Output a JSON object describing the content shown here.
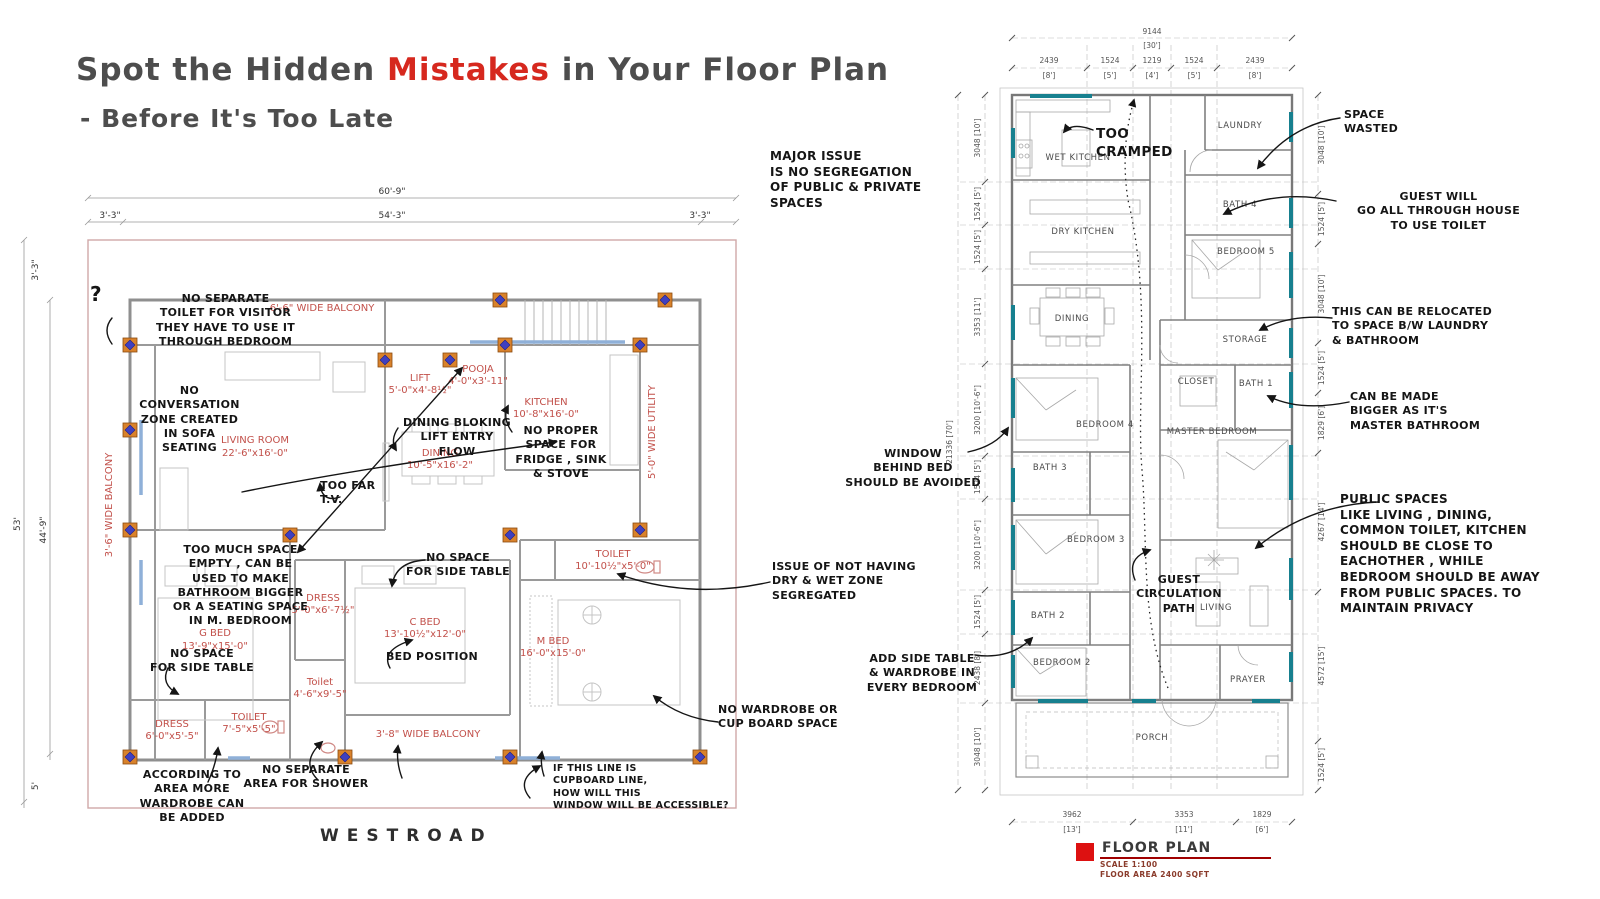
{
  "title": {
    "part1": "Spot the Hidden ",
    "highlight": "Mistakes",
    "part2": " in Your Floor Plan",
    "line2": "- Before It's Too Late"
  },
  "left_plan": {
    "caption": "WESTROAD",
    "dims": {
      "top_total": "60'-9\"",
      "top_left": "3'-3\"",
      "top_mid": "54'-3\"",
      "top_right": "3'-3\"",
      "side_total": "53'",
      "side_inner": "44'-9\"",
      "side_top": "3'-3\"",
      "side_bottom": "5'"
    },
    "rooms": {
      "balcony_top": {
        "name": "6'-6\" WIDE BALCONY"
      },
      "living": {
        "name": "LIVING ROOM",
        "size": "22'-6\"x16'-0\""
      },
      "lift": {
        "name": "LIFT",
        "size": "5'-0\"x4'-8½\""
      },
      "pooja": {
        "name": "POOJA",
        "size": "4'-0\"x3'-11\""
      },
      "kitchen": {
        "name": "KITCHEN",
        "size": "10'-8\"x16'-0\""
      },
      "dining": {
        "name": "DINING",
        "size": "10'-5\"x16'-2\""
      },
      "utility": {
        "name": "5'-0\" WIDE UTILITY"
      },
      "balcony_left": {
        "name": "3'-6\" WIDE BALCONY"
      },
      "gbed": {
        "name": "G BED",
        "size": "13'-9\"x15'-0\""
      },
      "dress1": {
        "name": "DRESS",
        "size": "5'-0\"x6'-7½\""
      },
      "cbed": {
        "name": "C BED",
        "size": "13'-10½\"x12'-0\""
      },
      "toilet_small": {
        "name": "Toilet",
        "size": "4'-6\"x9'-5\""
      },
      "toilet_m": {
        "name": "TOILET",
        "size": "10'-10½\"x5'-0\""
      },
      "mbed": {
        "name": "M BED",
        "size": "16'-0\"x15'-0\""
      },
      "dress2": {
        "name": "DRESS",
        "size": "6'-0\"x5'-5\""
      },
      "toilet2": {
        "name": "TOILET",
        "size": "7'-5\"x5'-5\""
      },
      "balcony_bottom": {
        "name": "3'-8\" WIDE BALCONY"
      }
    },
    "annotations": {
      "q_mark": "?",
      "no_separate_toilet": "NO SEPARATE\nTOILET FOR VISITOR\nTHEY HAVE TO USE IT\nTHROUGH BEDROOM",
      "no_conversation": "NO\nCONVERSATION\nZONE CREATED\nIN SOFA\nSEATING",
      "too_far_tv": "TOO FAR\nT.V.",
      "dining_blocking": "DINING BLOKING\nLIFT ENTRY\nFLOW",
      "no_proper_space": "NO PROPER\nSPACE FOR\nFRIDGE , SINK\n& STOVE",
      "too_much_space": "TOO MUCH SPACE\nEMPTY , CAN BE\nUSED TO MAKE\nBATHROOM BIGGER\nOR A SEATING SPACE\nIN M. BEDROOM",
      "no_side_table_g": "NO SPACE\nFOR SIDE TABLE",
      "no_side_table_c": "NO SPACE\nFOR SIDE TABLE",
      "bed_position": "BED POSITION",
      "according_area": "ACCORDING TO\nAREA MORE\nWARDROBE CAN\nBE ADDED",
      "no_shower_area": "NO SEPARATE\nAREA FOR SHOWER",
      "cupboard_line": "IF THIS LINE IS\nCUPBOARD LINE,\nHOW WILL THIS\nWINDOW WILL BE ACCESSIBLE?",
      "no_wardrobe": "NO WARDROBE OR\nCUP BOARD SPACE",
      "dry_wet_zone": "ISSUE OF NOT HAVING\nDRY & WET ZONE\nSEGREGATED"
    }
  },
  "right_plan": {
    "rooms": {
      "wet_kitchen": "WET KITCHEN",
      "laundry": "LAUNDRY",
      "dry_kitchen": "DRY KITCHEN",
      "bath4": "BATH 4",
      "bedroom5": "BEDROOM 5",
      "dining": "DINING",
      "storage": "STORAGE",
      "closet": "CLOSET",
      "bath1": "BATH 1",
      "bedroom4": "BEDROOM 4",
      "master": "MASTER BEDROOM",
      "bath3": "BATH 3",
      "bedroom3": "BEDROOM 3",
      "bath2": "BATH 2",
      "living": "LIVING",
      "bedroom2": "BEDROOM 2",
      "prayer": "PRAYER",
      "porch": "PORCH"
    },
    "dims": {
      "top_total": {
        "mm": "9144",
        "ft": "[30']"
      },
      "top": [
        {
          "mm": "2439",
          "ft": "[8']"
        },
        {
          "mm": "1524",
          "ft": "[5']"
        },
        {
          "mm": "1219",
          "ft": "[4']"
        },
        {
          "mm": "1524",
          "ft": "[5']"
        },
        {
          "mm": "2439",
          "ft": "[8']"
        }
      ],
      "left_total": "21336 [70']",
      "left": [
        "3048 [10']",
        "1524 [5']",
        "1524 [5']",
        "3353 [11']",
        "3200 [10'-6\"]",
        "1524 [5']",
        "3200 [10'-6\"]",
        "1524 [5']",
        "2438 [8']",
        "3048 [10']"
      ],
      "right": [
        "3048 [10']",
        "1524 [5']",
        "3048 [10']",
        "1524 [5']",
        "1829 [6']",
        "4267 [14']",
        "4572 [15']",
        "1524 [5']"
      ],
      "bottom": [
        {
          "mm": "3962",
          "ft": "[13']"
        },
        {
          "mm": "3353",
          "ft": "[11']"
        },
        {
          "mm": "1829",
          "ft": "[6']"
        }
      ]
    },
    "annotations": {
      "too_cramped": "TOO\nCRAMPED",
      "guest_circulation": "GUEST\nCIRCULATION\nPATH",
      "major_issue": "MAJOR ISSUE\nIS NO SEGREGATION\nOF PUBLIC & PRIVATE\nSPACES",
      "window_behind_bed": "WINDOW\nBEHIND BED\nSHOULD BE AVOIDED",
      "add_side_table": "ADD SIDE TABLE\n& WARDROBE IN\nEVERY BEDROOM",
      "space_wasted": "SPACE\nWASTED",
      "guest_toilet": "GUEST WILL\nGO ALL THROUGH HOUSE\nTO USE TOILET",
      "relocated": "THIS CAN BE RELOCATED\nTO SPACE B/W LAUNDRY\n& BATHROOM",
      "master_bathroom": "CAN BE MADE\nBIGGER AS IT'S\nMASTER BATHROOM",
      "public_spaces": "PUBLIC SPACES\nLIKE  LIVING , DINING,\nCOMMON TOILET,  KITCHEN\nSHOULD BE CLOSE TO\nEACHOTHER ,  WHILE\nBEDROOM SHOULD BE AWAY\nFROM PUBLIC SPACES. TO\nMAINTAIN PRIVACY"
    },
    "legend": {
      "title": "FLOOR PLAN",
      "scale": "SCALE 1:100",
      "area": "FLOOR AREA 2400 SQFT"
    }
  },
  "colors": {
    "accent_red": "#d6281e",
    "room_label_red": "#c2504a",
    "window_teal": "#17808f",
    "wall_gray": "#8f8f8f",
    "boundary_pink": "#cfa8a8"
  }
}
